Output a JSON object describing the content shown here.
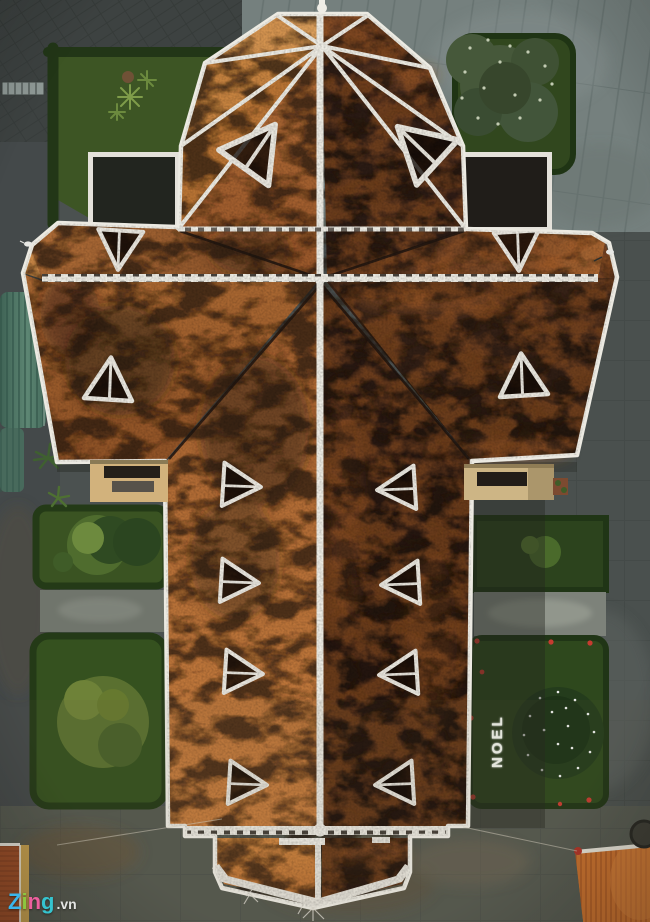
{
  "watermark": {
    "z": "Z",
    "i": "i",
    "n": "n",
    "g": "g",
    "suffix": ".vn"
  },
  "garden_text": {
    "noel": "NOEL"
  },
  "palette": {
    "ridgeWhite": "#eceae2",
    "noel": "#f2f2ea",
    "wmZ": "#3ab5ea",
    "wmI": "#8dc63f",
    "wmN": "#ec5f9e",
    "wmG": "#35c4cf",
    "wmVn": "#e3e4e2",
    "roofLit": "#c1793c",
    "roofLitBright": "#d6975a",
    "roofDark": "#2c1b13",
    "lawn": "#3a5322",
    "lawnDark": "#2e481d",
    "hedge": "#243a17",
    "paveLight": "#75807e",
    "paveDark": "#3d4241",
    "paveBase": "#4b5150",
    "corrugatedRoof": "#4f7764",
    "cornerRoofLeft": "#9c4c27",
    "cornerWallLeft": "#c7a04e",
    "cornerRoofRight": "#c9702d",
    "flowerRed": "#c63b30",
    "treeLights": "#ffffff"
  }
}
